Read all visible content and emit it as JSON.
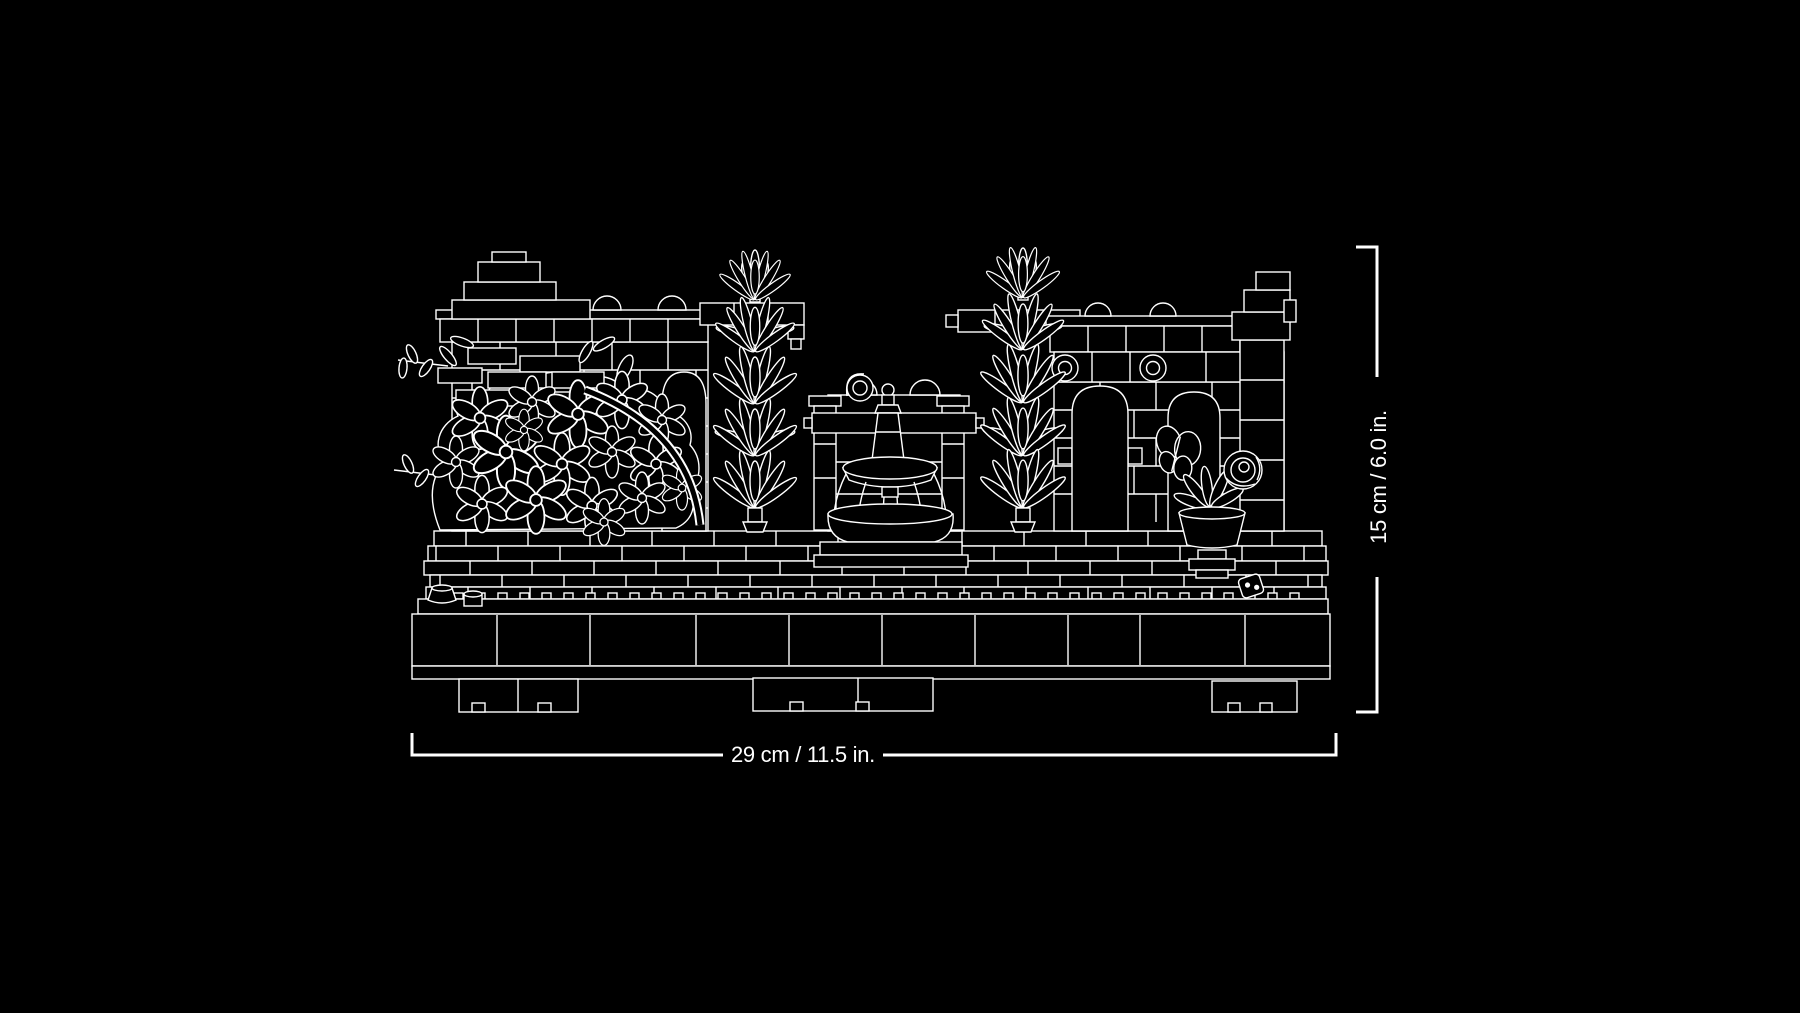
{
  "canvas": {
    "background": "#000000",
    "line_color": "#ffffff"
  },
  "figure": {
    "name": "lego-garden-diorama-blueprint",
    "parts": [
      "baseplate",
      "left-ruin-wall",
      "flower-bush",
      "cypress-tree-left",
      "fountain",
      "cypress-tree-right",
      "right-ruin-wall",
      "potted-plant",
      "ladybug"
    ]
  },
  "dimensions": {
    "width": {
      "label": "29 cm / 11.5 in."
    },
    "height": {
      "label": "15 cm / 6.0 in."
    }
  }
}
